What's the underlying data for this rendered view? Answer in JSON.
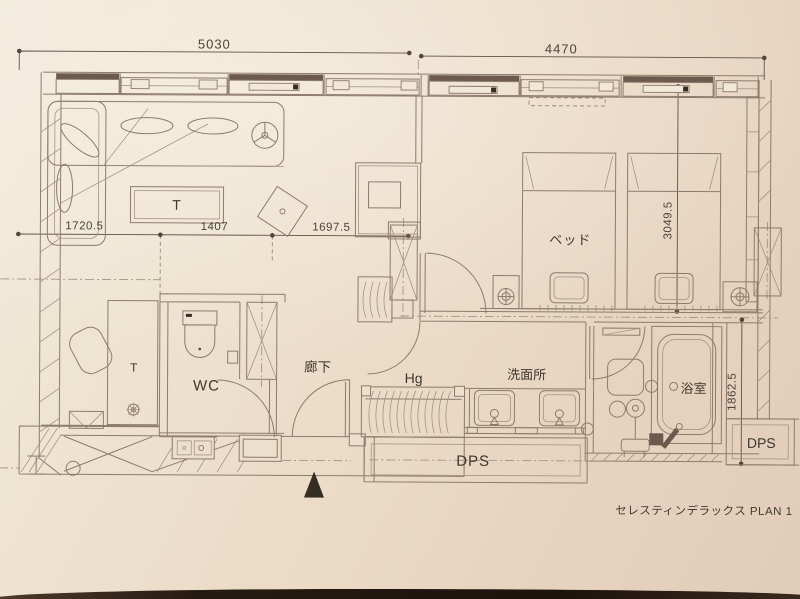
{
  "plan": {
    "caption": "セレスティンデラックス PLAN 1",
    "dimensions": {
      "top_left_width": "5030",
      "top_right_width": "4470",
      "mid_left": "1720.5",
      "mid_center": "1407",
      "mid_right": "1697.5",
      "bed_depth": "3049.5",
      "bath_depth": "1862.5"
    },
    "rooms": {
      "bed": "ベッド",
      "wc": "WC",
      "corridor": "廊下",
      "hanger_rack": "Hg",
      "washroom": "洗面所",
      "bathroom": "浴室",
      "living_table": "T",
      "desk_table": "T",
      "dps_main": "DPS",
      "dps_right": "DPS"
    },
    "colors": {
      "paper": "#ead9c5",
      "line": "#8d7b6c",
      "dark_fill": "#6b5a4d",
      "text": "#483e34",
      "photo_edge": "#261b12"
    }
  }
}
